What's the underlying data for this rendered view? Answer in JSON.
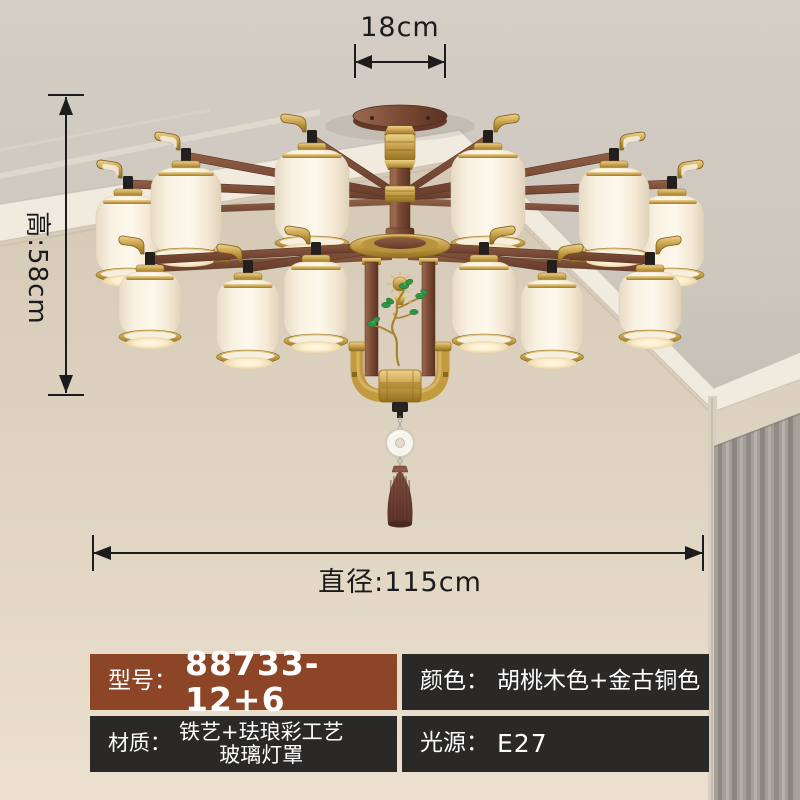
{
  "dimensions": {
    "top_width": "18cm",
    "height": "高:58cm",
    "diameter": "直径:115cm"
  },
  "specs": {
    "model": {
      "label": "型号：",
      "value": "88733-12+6"
    },
    "color": {
      "label": "颜色：",
      "value": "胡桃木色+金古铜色"
    },
    "material": {
      "label": "材质：",
      "value_line1": "铁艺+珐琅彩工艺",
      "value_line2": "玻璃灯罩"
    },
    "light_source": {
      "label": "光源：",
      "value": "E27"
    }
  },
  "colors": {
    "accent_brown": "#8D4527",
    "panel_dark": "#2A2928",
    "gold": "#C9A24B",
    "wood": "#7A4A33",
    "shade_cream": "#FBF4E4",
    "curtain_gray": "#A49F98"
  }
}
